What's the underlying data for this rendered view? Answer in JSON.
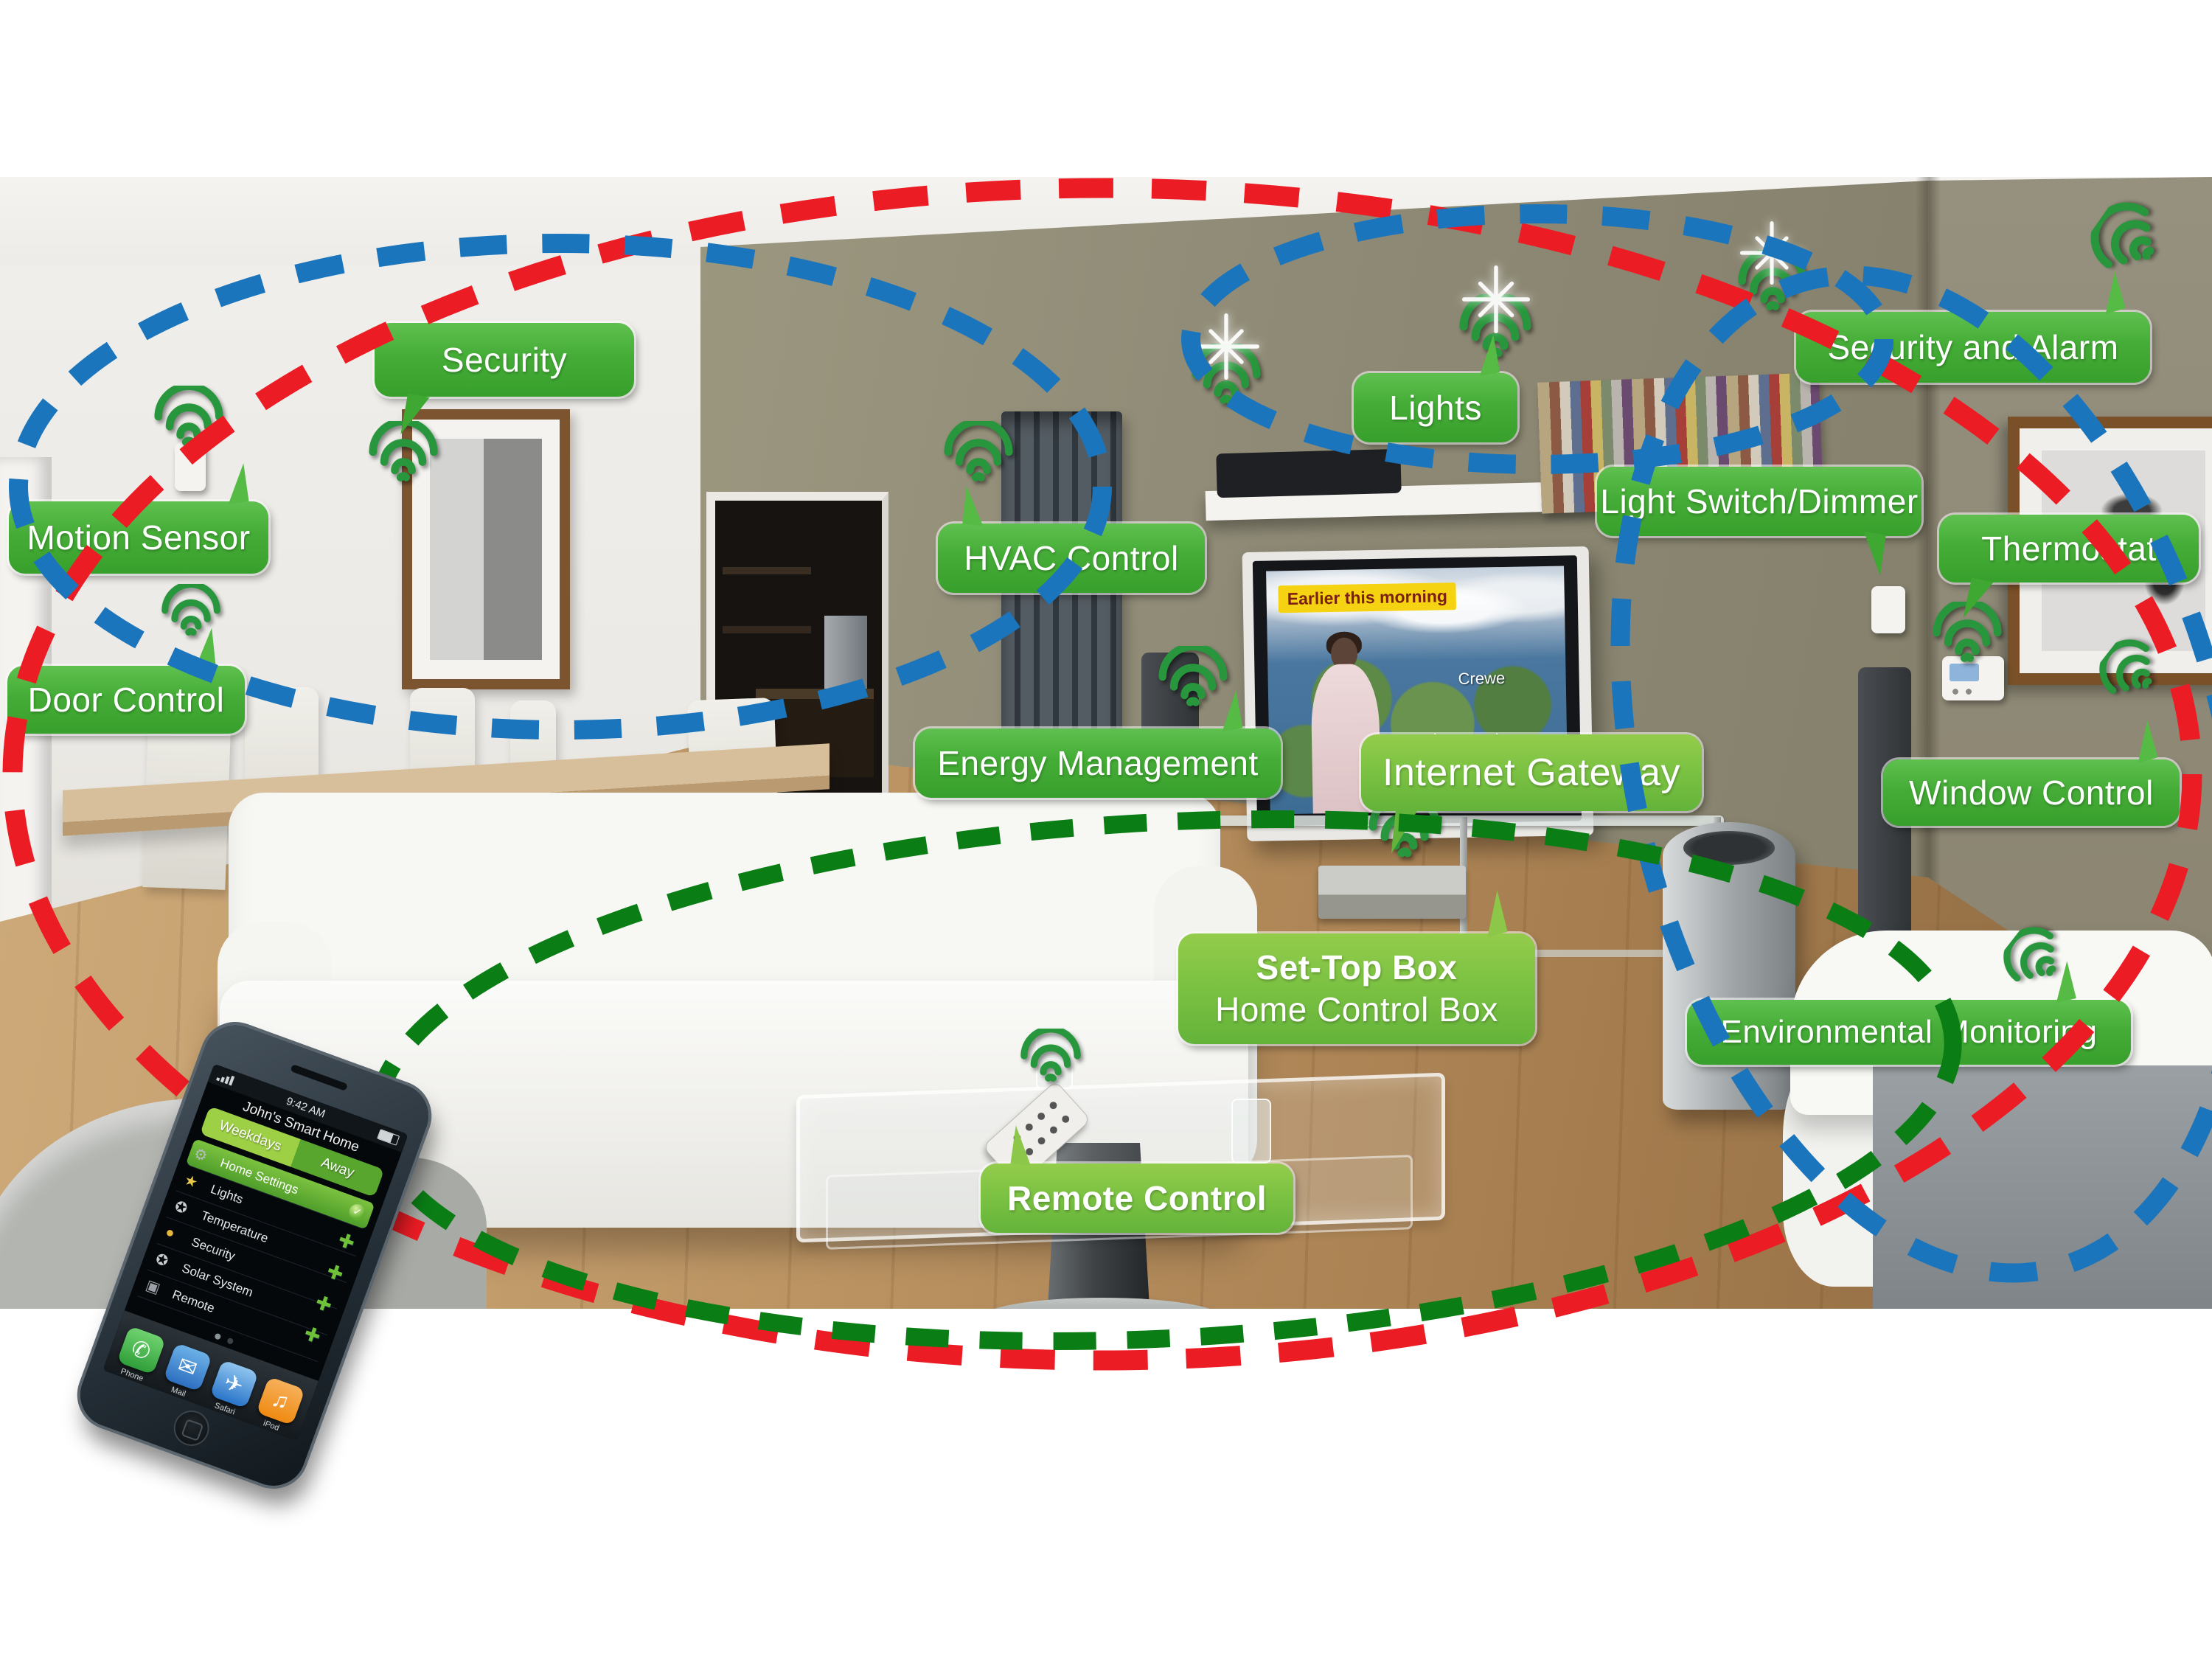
{
  "labels": [
    {
      "id": "security",
      "text": "Security"
    },
    {
      "id": "motion",
      "text": "Motion Sensor"
    },
    {
      "id": "door",
      "text": "Door Control"
    },
    {
      "id": "hvac",
      "text": "HVAC Control"
    },
    {
      "id": "lights",
      "text": "Lights"
    },
    {
      "id": "salarm",
      "text": "Security and Alarm"
    },
    {
      "id": "dimmer",
      "text": "Light Switch/Dimmer"
    },
    {
      "id": "thermostat",
      "text": "Thermostat"
    },
    {
      "id": "energy",
      "text": "Energy Management"
    },
    {
      "id": "gateway",
      "text": "Internet Gateway"
    },
    {
      "id": "settop",
      "line1": "Set-Top Box",
      "line2": "Home Control Box"
    },
    {
      "id": "window",
      "text": "Window Control"
    },
    {
      "id": "env",
      "text": "Environmental Monitoring"
    },
    {
      "id": "remote",
      "text": "Remote Control"
    }
  ],
  "tv": {
    "chip": "Earlier this morning",
    "cities": [
      "Crewe",
      "Lancaster"
    ]
  },
  "phone": {
    "time": "9:42 AM",
    "title": "John's Smart Home",
    "mode_left": "Weekdays",
    "mode_right": "Away",
    "rows": [
      "Home Settings",
      "Lights",
      "Temperature",
      "Security",
      "Solar System",
      "Remote"
    ],
    "app_icons": [
      {
        "glyph": "⚙"
      },
      {
        "glyph": "★"
      },
      {
        "glyph": "✪"
      },
      {
        "glyph": "●"
      },
      {
        "glyph": "✪"
      },
      {
        "glyph": "▣"
      }
    ],
    "check_glyph": "✓",
    "plus_glyph": "✚",
    "dock": [
      {
        "label": "Phone",
        "glyph": "✆"
      },
      {
        "label": "Mail",
        "glyph": "✉"
      },
      {
        "label": "Safari",
        "glyph": "✈"
      },
      {
        "label": "iPod",
        "glyph": "♫"
      }
    ]
  },
  "colors": {
    "label_green": "#45ad37",
    "label_bright_green": "#7ac142",
    "wifi_green": "#28963c",
    "dash_red": "#ec1c24",
    "dash_blue": "#1b75bc",
    "dash_green": "#0a7d15"
  }
}
